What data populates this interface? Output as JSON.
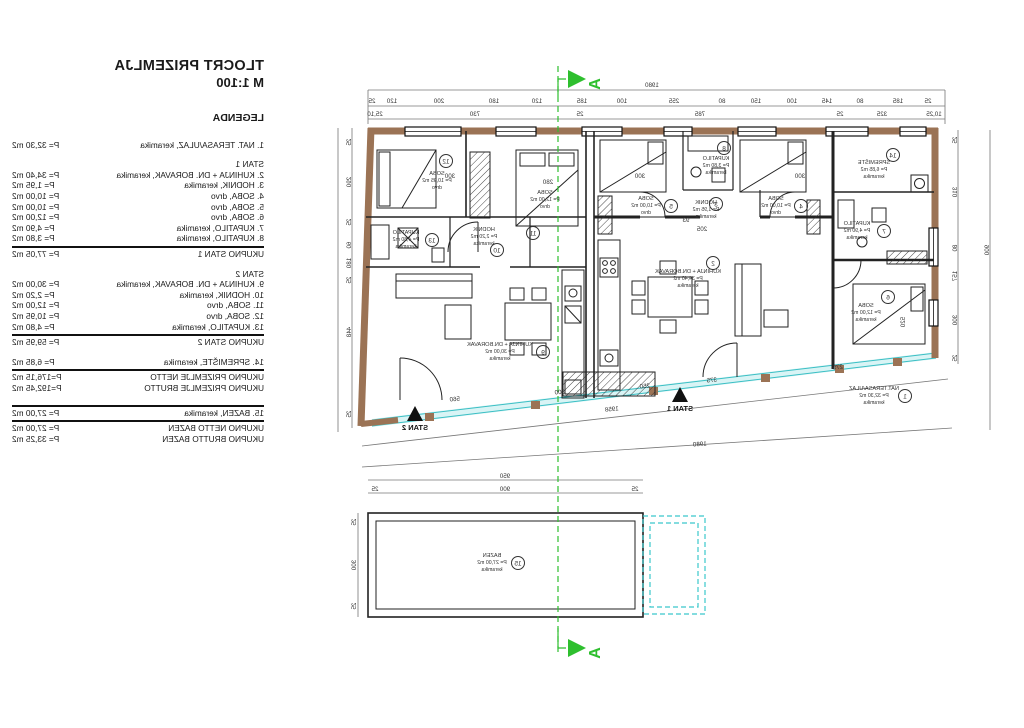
{
  "colors": {
    "wall": "#9b7355",
    "glass_line": "#3bbfc4",
    "glass_fill": "#d9f4f5",
    "section_green": "#2ebf2e",
    "ink": "#1a1a1a",
    "dim": "#444444"
  },
  "legend": {
    "title": "TLOCRT PRIZEMLJA",
    "scale": "M 1:100",
    "heading": "LEGENDA",
    "rows": [
      {
        "t": "item",
        "l": "1. NAT. TERASA/ULAZ, keramika",
        "v": "P= 32,30 m2"
      },
      {
        "t": "gap"
      },
      {
        "t": "head",
        "l": "STAN 1"
      },
      {
        "t": "item",
        "l": "2. KUHINJA + DN. BORAVAK, keramika",
        "v": "P= 34,40 m2"
      },
      {
        "t": "item",
        "l": "3. HODNIK, keramika",
        "v": "P= 1,95 m2"
      },
      {
        "t": "item",
        "l": "4. SOBA, drvo",
        "v": "P= 10,00 m2"
      },
      {
        "t": "item",
        "l": "5. SOBA, drvo",
        "v": "P= 10,00 m2"
      },
      {
        "t": "item",
        "l": "6. SOBA, drvo",
        "v": "P= 12,00 m2"
      },
      {
        "t": "item",
        "l": "7. KUPATILO, keramika",
        "v": "P= 4,90 m2"
      },
      {
        "t": "item",
        "l": "8. KUPATILO, keramika",
        "v": "P= 3,80 m2"
      },
      {
        "t": "rule"
      },
      {
        "t": "item",
        "l": "UKUPNO STAN 1",
        "v": "P= 77,05 m2"
      },
      {
        "t": "gap"
      },
      {
        "t": "head",
        "l": "STAN 2"
      },
      {
        "t": "item",
        "l": "9. KUHINJA + DN. BORAVAK, keramika",
        "v": "P= 30,00 m2"
      },
      {
        "t": "item",
        "l": "10. HODNIK, keramika",
        "v": "P= 2,20 m2"
      },
      {
        "t": "item",
        "l": "11. SOBA, drvo",
        "v": "P= 12,00 m2"
      },
      {
        "t": "item",
        "l": "12. SOBA, drvo",
        "v": "P= 10,95 m2"
      },
      {
        "t": "item",
        "l": "13. KUPATILO, keramika",
        "v": "P= 4,80 m2"
      },
      {
        "t": "rule"
      },
      {
        "t": "item",
        "l": "UKUPNO STAN 2",
        "v": "P= 59,95 m2"
      },
      {
        "t": "gap"
      },
      {
        "t": "item",
        "l": "14. SPREMIŠTE, keramika",
        "v": "P= 6,85 m2"
      },
      {
        "t": "rule"
      },
      {
        "t": "item",
        "l": "UKUPNO PRIZEMLJE NETTO",
        "v": "P=176,15 m2"
      },
      {
        "t": "item",
        "l": "UKUPNO PRIZEMLJE BRUTTO",
        "v": "P=192,45 m2"
      },
      {
        "t": "gap"
      },
      {
        "t": "rule"
      },
      {
        "t": "item",
        "l": "15. BAZEN, keramika",
        "v": "P= 27,00 m2"
      },
      {
        "t": "rule"
      },
      {
        "t": "item",
        "l": "UKUPNO NETTO BAZEN",
        "v": "P= 27,00 m2"
      },
      {
        "t": "item",
        "l": "UKUPNO BRUTTO BAZEN",
        "v": "P= 33,25 m2"
      }
    ]
  },
  "plan": {
    "section_letter": "A",
    "entrances": [
      {
        "label": "STAN 2",
        "x": 415,
        "y": 430
      },
      {
        "label": "STAN 1",
        "x": 680,
        "y": 411
      }
    ],
    "rooms": [
      {
        "n": "1",
        "name": "NAT.TERASA/ULAZ",
        "area": "P= 32,30 m2",
        "mat": "keramika",
        "cx": 905,
        "cy": 396,
        "tx": 874,
        "ty": 396
      },
      {
        "n": "2",
        "name": "KUHINJA + DN.BORAVAK",
        "area": "P= 34,40 m2",
        "mat": "keramika",
        "cx": 713,
        "cy": 263,
        "tx": 688,
        "ty": 279
      },
      {
        "n": "3",
        "name": "HODNIK",
        "area": "P= 1,95 m2",
        "mat": "keramika",
        "cx": 716,
        "cy": 204,
        "tx": 706,
        "ty": 210
      },
      {
        "n": "4",
        "name": "SOBA",
        "area": "P= 10,00 m2",
        "mat": "drvo",
        "cx": 801,
        "cy": 206,
        "tx": 776,
        "ty": 206
      },
      {
        "n": "5",
        "name": "SOBA",
        "area": "P= 10,00 m2",
        "mat": "drvo",
        "cx": 671,
        "cy": 206,
        "tx": 646,
        "ty": 206
      },
      {
        "n": "6",
        "name": "SOBA",
        "area": "P= 12,00 m2",
        "mat": "keramika",
        "cx": 888,
        "cy": 297,
        "tx": 866,
        "ty": 313
      },
      {
        "n": "7",
        "name": "KUPATILO",
        "area": "P= 4,90 m2",
        "mat": "keramika",
        "cx": 884,
        "cy": 231,
        "tx": 857,
        "ty": 231
      },
      {
        "n": "8",
        "name": "KUPATILO",
        "area": "P= 3,80 m2",
        "mat": "keramika",
        "cx": 724,
        "cy": 148,
        "tx": 716,
        "ty": 166
      },
      {
        "n": "9",
        "name": "KUHINJA + DN.BORAVAK",
        "area": "P= 30,00 m2",
        "mat": "keramika",
        "cx": 543,
        "cy": 352,
        "tx": 500,
        "ty": 352
      },
      {
        "n": "10",
        "name": "HODNIK",
        "area": "P= 2,20 m2",
        "mat": "keramika",
        "cx": 497,
        "cy": 250,
        "tx": 484,
        "ty": 237
      },
      {
        "n": "11",
        "name": "SOBA",
        "area": "P= 12,00 m2",
        "mat": "drvo",
        "cx": 533,
        "cy": 233,
        "tx": 545,
        "ty": 200
      },
      {
        "n": "12",
        "name": "SOBA",
        "area": "P= 10,95 m2",
        "mat": "drvo",
        "cx": 446,
        "cy": 161,
        "tx": 437,
        "ty": 181
      },
      {
        "n": "13",
        "name": "KUPATILO",
        "area": "P= 4,80 m2",
        "mat": "keramika",
        "cx": 432,
        "cy": 240,
        "tx": 406,
        "ty": 240
      },
      {
        "n": "14",
        "name": "SPREMIŠTE",
        "area": "P= 6,85 m2",
        "mat": "keramika",
        "cx": 893,
        "cy": 155,
        "tx": 874,
        "ty": 170
      },
      {
        "n": "15",
        "name": "BAZEN",
        "area": "P= 27,00 m2",
        "mat": "keramika",
        "cx": 518,
        "cy": 563,
        "tx": 492,
        "ty": 563
      }
    ],
    "dim_labels": [
      {
        "v": "1980",
        "x": 652,
        "y": 87
      },
      {
        "v": "25",
        "x": 372,
        "y": 103
      },
      {
        "v": "120",
        "x": 392,
        "y": 103
      },
      {
        "v": "200",
        "x": 439,
        "y": 103
      },
      {
        "v": "180",
        "x": 494,
        "y": 103
      },
      {
        "v": "120",
        "x": 537,
        "y": 103
      },
      {
        "v": "185",
        "x": 582,
        "y": 103
      },
      {
        "v": "100",
        "x": 622,
        "y": 103
      },
      {
        "v": "255",
        "x": 674,
        "y": 103
      },
      {
        "v": "80",
        "x": 722,
        "y": 103
      },
      {
        "v": "150",
        "x": 756,
        "y": 103
      },
      {
        "v": "100",
        "x": 792,
        "y": 103
      },
      {
        "v": "145",
        "x": 827,
        "y": 103
      },
      {
        "v": "80",
        "x": 860,
        "y": 103
      },
      {
        "v": "185",
        "x": 898,
        "y": 103
      },
      {
        "v": "25",
        "x": 928,
        "y": 103
      },
      {
        "v": "25,10",
        "x": 375,
        "y": 116
      },
      {
        "v": "730",
        "x": 475,
        "y": 116
      },
      {
        "v": "25",
        "x": 580,
        "y": 116
      },
      {
        "v": "785",
        "x": 700,
        "y": 116
      },
      {
        "v": "25",
        "x": 840,
        "y": 116
      },
      {
        "v": "325",
        "x": 882,
        "y": 116
      },
      {
        "v": "10,25",
        "x": 934,
        "y": 116
      },
      {
        "v": "25",
        "x": 957,
        "y": 140,
        "r": -90
      },
      {
        "v": "310",
        "x": 957,
        "y": 192,
        "r": -90
      },
      {
        "v": "80",
        "x": 957,
        "y": 248,
        "r": -90
      },
      {
        "v": "157",
        "x": 957,
        "y": 276,
        "r": -90
      },
      {
        "v": "300",
        "x": 957,
        "y": 320,
        "r": -90
      },
      {
        "v": "25",
        "x": 957,
        "y": 358,
        "r": -90
      },
      {
        "v": "900",
        "x": 989,
        "y": 250,
        "r": -90
      },
      {
        "v": "25",
        "x": 351,
        "y": 142,
        "r": -90
      },
      {
        "v": "290",
        "x": 351,
        "y": 182,
        "r": -90
      },
      {
        "v": "25",
        "x": 351,
        "y": 222,
        "r": -90
      },
      {
        "v": "60",
        "x": 351,
        "y": 245,
        "r": -90
      },
      {
        "v": "180",
        "x": 351,
        "y": 263,
        "r": -90
      },
      {
        "v": "25",
        "x": 351,
        "y": 280,
        "r": -90
      },
      {
        "v": "448",
        "x": 351,
        "y": 332,
        "r": -90
      },
      {
        "v": "25",
        "x": 351,
        "y": 414,
        "r": -90
      },
      {
        "v": "560",
        "x": 455,
        "y": 401,
        "r": -6
      },
      {
        "v": "300",
        "x": 560,
        "y": 394,
        "r": -6
      },
      {
        "v": "250",
        "x": 645,
        "y": 388,
        "r": -6
      },
      {
        "v": "375",
        "x": 712,
        "y": 382,
        "r": -6
      },
      {
        "v": "275",
        "x": 838,
        "y": 369,
        "r": -6
      },
      {
        "v": "1958",
        "x": 612,
        "y": 411,
        "r": -6
      },
      {
        "v": "1980",
        "x": 700,
        "y": 446,
        "r": -4
      },
      {
        "v": "300",
        "x": 450,
        "y": 178
      },
      {
        "v": "280",
        "x": 548,
        "y": 184
      },
      {
        "v": "300",
        "x": 640,
        "y": 178
      },
      {
        "v": "300",
        "x": 800,
        "y": 178
      },
      {
        "v": "205",
        "x": 702,
        "y": 231
      },
      {
        "v": "93",
        "x": 686,
        "y": 222
      },
      {
        "v": "520",
        "x": 905,
        "y": 322,
        "r": -90
      },
      {
        "v": "950",
        "x": 505,
        "y": 478
      },
      {
        "v": "900",
        "x": 505,
        "y": 491
      },
      {
        "v": "25",
        "x": 375,
        "y": 491
      },
      {
        "v": "25",
        "x": 635,
        "y": 491
      },
      {
        "v": "25",
        "x": 356,
        "y": 522,
        "r": -90
      },
      {
        "v": "300",
        "x": 356,
        "y": 565,
        "r": -90
      },
      {
        "v": "25",
        "x": 356,
        "y": 606,
        "r": -90
      }
    ]
  }
}
